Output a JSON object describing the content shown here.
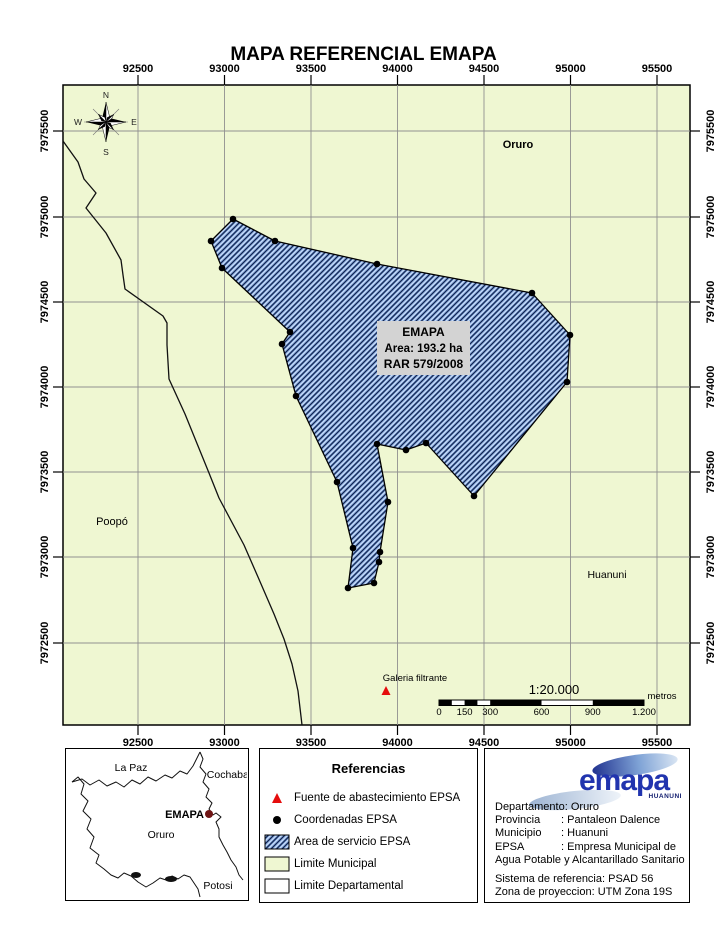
{
  "title": "MAPA REFERENCIAL EMAPA",
  "map": {
    "x_ticks": [
      "92500",
      "93000",
      "93500",
      "94000",
      "94500",
      "95000",
      "95500"
    ],
    "y_ticks": [
      "7975500",
      "7975000",
      "7974500",
      "7974000",
      "7973500",
      "7973000",
      "7972500"
    ],
    "compass": {
      "n": "N",
      "e": "E",
      "s": "S",
      "w": "W"
    },
    "labels": {
      "oruro": "Oruro",
      "poopo": "Poopó",
      "huanuni": "Huanuni",
      "galeria_filtrante": "Galeria filtrante"
    },
    "area_label": {
      "line1": "EMAPA",
      "line2": "Area: 193.2 ha",
      "line3": "RAR 579/2008"
    },
    "scale": {
      "ratio": "1:20.000",
      "ticks": [
        "0",
        "150",
        "300",
        "600",
        "900",
        "1.200"
      ],
      "unit": "metros"
    }
  },
  "overview": {
    "labels": {
      "la_paz": "La Paz",
      "cochabamba": "Cochabamba",
      "emapa": "EMAPA",
      "oruro": "Oruro",
      "potosi": "Potosi"
    }
  },
  "legend": {
    "title": "Referencias",
    "items": [
      "Fuente de abastecimiento EPSA",
      "Coordenadas EPSA",
      "Area de servicio EPSA",
      "Limite Municipal",
      "Limite Departamental"
    ]
  },
  "info": {
    "colon": ":",
    "rows": [
      {
        "label": "Departamento",
        "value": "Oruro"
      },
      {
        "label": "Provincia",
        "value": "Pantaleon Dalence"
      },
      {
        "label": "Municipio",
        "value": "Huanuni"
      },
      {
        "label": "EPSA",
        "value": "Empresa Municipal de"
      }
    ],
    "epsa_continuation": "Agua Potable y Alcantarillado Sanitario",
    "reference_system": "Sistema de referencia: PSAD 56",
    "projection_zone": "Zona de proyeccion: UTM Zona 19S",
    "logo": {
      "name": "emapa",
      "subtitle": "HUANUNI"
    }
  },
  "colors": {
    "municipal_fill": "#eff7d2",
    "service_area_fill": "#86ace4",
    "hatch_line": "#13234d",
    "epsa_red": "#e50d0d",
    "logo_blue": "#2134ae",
    "grid_grey": "#909090"
  }
}
